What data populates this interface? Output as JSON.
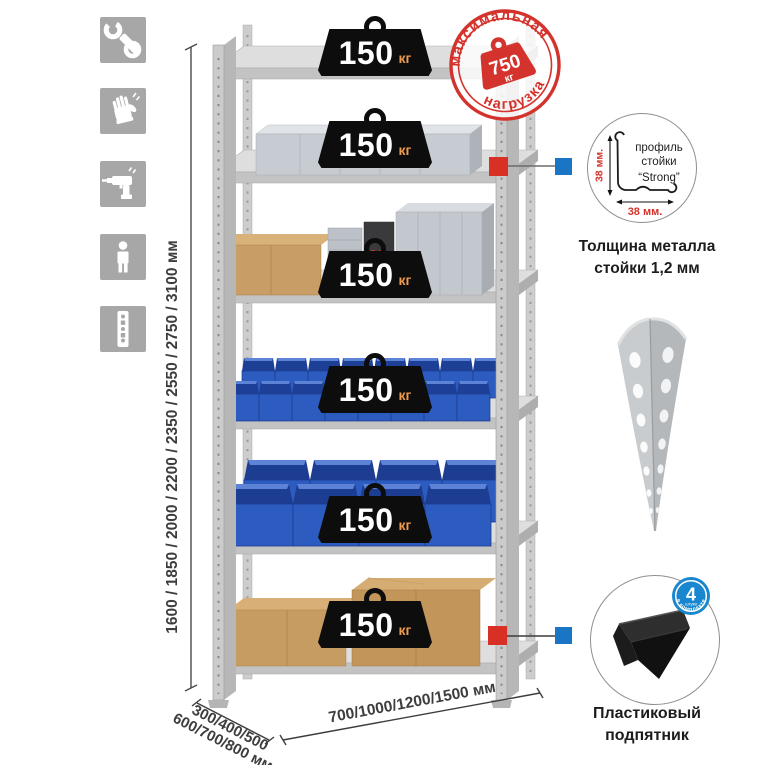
{
  "page": {
    "background": "#ffffff"
  },
  "colors": {
    "accent_red": "#d4332d",
    "accent_blue": "#1a75c5",
    "bin_blue": "#2d5cc0",
    "icon_gray": "#a7a7a7",
    "badge_black": "#0d0d0d",
    "kg_orange": "#ef9b4f"
  },
  "left_icons": [
    {
      "name": "wrench-icon"
    },
    {
      "name": "gloves-icon"
    },
    {
      "name": "drill-icon"
    },
    {
      "name": "person-icon"
    },
    {
      "name": "rack-post-icon"
    }
  ],
  "stamp": {
    "arc_top": "максимальная",
    "arc_bottom": "нагрузка",
    "weight_value": "750",
    "weight_unit": "кг"
  },
  "shelf_badge": {
    "value": "150",
    "unit": "кг"
  },
  "dims": {
    "height": "1600 / 1850 / 2000 / 2200 / 2350 / 2550 / 2750 / 3100 мм",
    "depth_line1": "300/400/500",
    "depth_line2": "600/700/800 мм",
    "width": "700/1000/1200/1500 мм"
  },
  "profile_detail": {
    "label_line1": "профиль",
    "label_line2": "стойки",
    "label_line3": "“Strong”",
    "dim_vertical": "38 мм.",
    "dim_horizontal": "38 мм.",
    "caption_line1": "Толщина металла",
    "caption_line2": "стойки 1,2 мм"
  },
  "foot_detail": {
    "badge_number": "4",
    "badge_subtext": "штуки",
    "badge_arc": "в комплекте",
    "caption_line1": "Пластиковый",
    "caption_line2": "подпятник"
  }
}
